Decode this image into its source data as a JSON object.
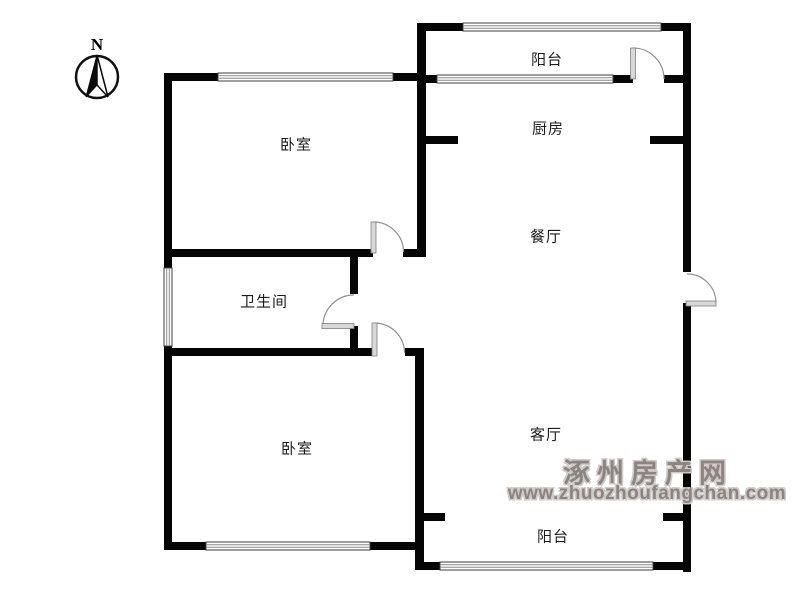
{
  "compass": {
    "label": "N"
  },
  "rooms": {
    "balcony_top": {
      "label": "阳台"
    },
    "kitchen": {
      "label": "厨房"
    },
    "bedroom_top": {
      "label": "卧室"
    },
    "dining": {
      "label": "餐厅"
    },
    "bathroom": {
      "label": "卫生间"
    },
    "bedroom_bottom": {
      "label": "卧室"
    },
    "living": {
      "label": "客厅"
    },
    "balcony_bottom": {
      "label": "阳台"
    }
  },
  "watermark": {
    "site_name": "涿州房产网",
    "url": "www.zhuozhoufangchan.com"
  },
  "colors": {
    "wall": "#050505",
    "window_frame": "#3c3c3c",
    "window_pane": "#8a8a8a",
    "door_leaf": "#d8d8d8",
    "door_arc": "#909090",
    "watermark_gray": "#8b8481"
  }
}
